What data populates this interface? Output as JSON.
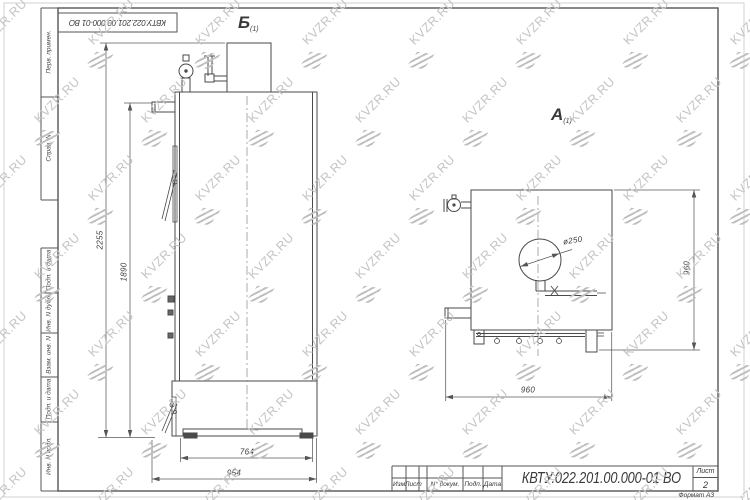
{
  "watermark": {
    "text": "KVZR.RU"
  },
  "frame": {
    "top_box_text": "КВТУ.022.201.00.000-01 ВО",
    "left_column": [
      "Перв. примен.",
      "Справ. N",
      "Подп. и дата",
      "Инв. N дубл.",
      "Взам. инв. N",
      "Подп. и дата",
      "Инв. N подл."
    ]
  },
  "title_block": {
    "doc_number": "КВТУ.022.201.00.000-01 ВО",
    "columns": [
      "Изм",
      "Лист",
      "N° докум.",
      "Подп.",
      "Дата"
    ],
    "sheet_label": "Лист",
    "sheet_number": "2",
    "format_label": "Формат А3"
  },
  "views": {
    "front": {
      "label": "Б",
      "label_sub": "(1)"
    },
    "side": {
      "label": "А",
      "label_sub": "(1)"
    }
  },
  "dimensions": {
    "total_height": "2255",
    "body_height": "1890",
    "body_width": "764",
    "total_width": "954",
    "side_width": "960",
    "side_height": "960",
    "diameter": "ø250"
  }
}
